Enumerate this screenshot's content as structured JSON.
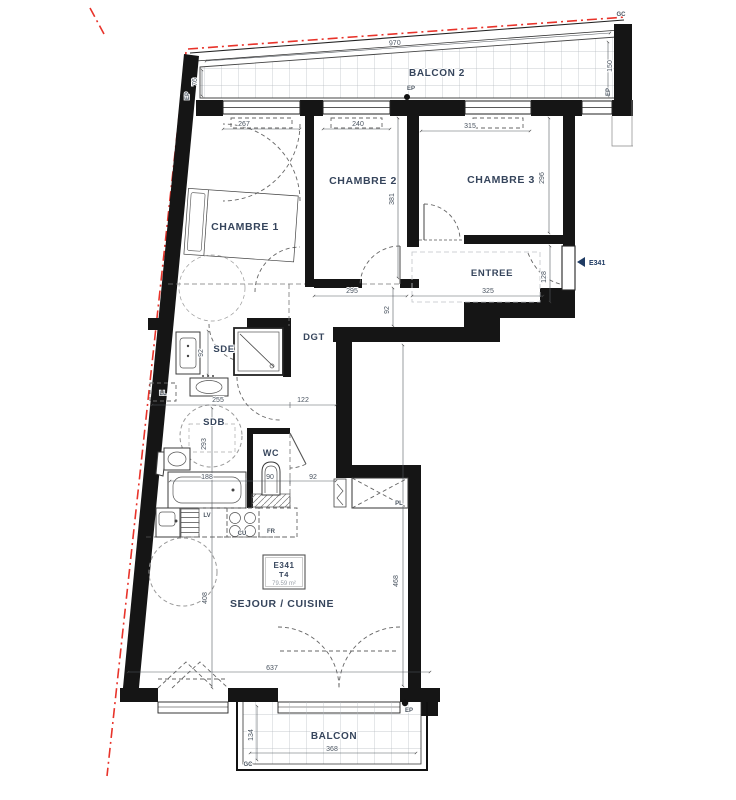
{
  "rooms": {
    "balcon2": "BALCON 2",
    "chambre1": "CHAMBRE 1",
    "chambre2": "CHAMBRE 2",
    "chambre3": "CHAMBRE 3",
    "entree": "ENTREE",
    "sde": "SDE",
    "dgt": "DGT",
    "sdb": "SDB",
    "wc": "WC",
    "sejour": "SEJOUR / CUISINE",
    "balcon": "BALCON"
  },
  "unit": {
    "code": "E341",
    "type": "T4",
    "area": "79.59 m²",
    "entry_label": "E341"
  },
  "equipment": {
    "ll": "LL",
    "lv": "LV",
    "cu": "CU",
    "fr": "FR",
    "pl": "PL"
  },
  "marks": {
    "ep": "EP",
    "gc": "GC"
  },
  "dims": {
    "balcon2_width": "970",
    "balcon2_depth": "150",
    "balcon2_left": "76",
    "chambre1_width": "267",
    "chambre2_width": "240",
    "chambre3_width": "315",
    "chambre2_depth": "381",
    "chambre3_depth": "296",
    "hall_width": "295",
    "hall_depth": "92",
    "entree_width": "325",
    "entree_door": "128",
    "sdb_width": "255",
    "dgt_width": "122",
    "sde_depth": "92",
    "sdb_depth": "293",
    "bath_length": "188",
    "wc_width": "90",
    "corridor_width": "92",
    "sejour_left": "408",
    "sejour_right": "468",
    "sejour_width": "637",
    "balcon_width": "368",
    "balcon_depth": "134"
  },
  "colors": {
    "wall": "#151515",
    "label": "#36455c",
    "dim": "#4a5460",
    "property_line": "#e8332a",
    "entry_arrow": "#1f3b63"
  }
}
